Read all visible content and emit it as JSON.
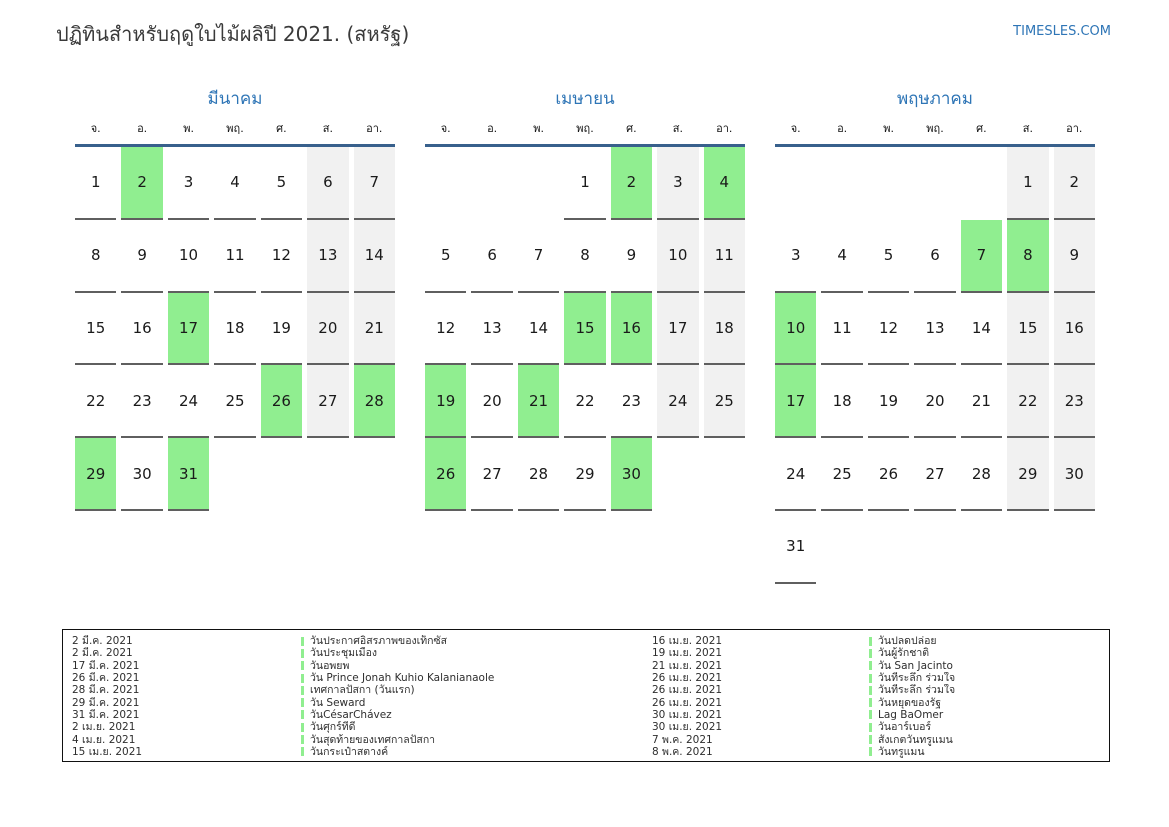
{
  "header": {
    "title": "ปฏิทินสำหรับฤดูใบไม้ผลิปี 2021. (สหรัฐ)",
    "site_link": "TIMESLES.COM"
  },
  "colors": {
    "accent_blue": "#2e75b6",
    "header_line_blue": "#38608c",
    "holiday_green": "#90ee90",
    "weekend_gray": "#f1f1f1"
  },
  "weekdays": [
    "จ.",
    "อ.",
    "พ.",
    "พฤ.",
    "ศ.",
    "ส.",
    "อา."
  ],
  "months": [
    {
      "name": "มีนาคม",
      "weeks": [
        [
          {
            "day": 1,
            "type": "normal"
          },
          {
            "day": 2,
            "type": "holiday"
          },
          {
            "day": 3,
            "type": "normal"
          },
          {
            "day": 4,
            "type": "normal"
          },
          {
            "day": 5,
            "type": "normal"
          },
          {
            "day": 6,
            "type": "weekend"
          },
          {
            "day": 7,
            "type": "weekend"
          }
        ],
        [
          {
            "day": 8,
            "type": "normal"
          },
          {
            "day": 9,
            "type": "normal"
          },
          {
            "day": 10,
            "type": "normal"
          },
          {
            "day": 11,
            "type": "normal"
          },
          {
            "day": 12,
            "type": "normal"
          },
          {
            "day": 13,
            "type": "weekend"
          },
          {
            "day": 14,
            "type": "weekend"
          }
        ],
        [
          {
            "day": 15,
            "type": "normal"
          },
          {
            "day": 16,
            "type": "normal"
          },
          {
            "day": 17,
            "type": "holiday"
          },
          {
            "day": 18,
            "type": "normal"
          },
          {
            "day": 19,
            "type": "normal"
          },
          {
            "day": 20,
            "type": "weekend"
          },
          {
            "day": 21,
            "type": "weekend"
          }
        ],
        [
          {
            "day": 22,
            "type": "normal"
          },
          {
            "day": 23,
            "type": "normal"
          },
          {
            "day": 24,
            "type": "normal"
          },
          {
            "day": 25,
            "type": "normal"
          },
          {
            "day": 26,
            "type": "holiday"
          },
          {
            "day": 27,
            "type": "weekend"
          },
          {
            "day": 28,
            "type": "holiday"
          }
        ],
        [
          {
            "day": 29,
            "type": "holiday"
          },
          {
            "day": 30,
            "type": "normal"
          },
          {
            "day": 31,
            "type": "holiday"
          },
          null,
          null,
          null,
          null
        ]
      ]
    },
    {
      "name": "เมษายน",
      "weeks": [
        [
          null,
          null,
          null,
          {
            "day": 1,
            "type": "normal"
          },
          {
            "day": 2,
            "type": "holiday"
          },
          {
            "day": 3,
            "type": "weekend"
          },
          {
            "day": 4,
            "type": "holiday"
          }
        ],
        [
          {
            "day": 5,
            "type": "normal"
          },
          {
            "day": 6,
            "type": "normal"
          },
          {
            "day": 7,
            "type": "normal"
          },
          {
            "day": 8,
            "type": "normal"
          },
          {
            "day": 9,
            "type": "normal"
          },
          {
            "day": 10,
            "type": "weekend"
          },
          {
            "day": 11,
            "type": "weekend"
          }
        ],
        [
          {
            "day": 12,
            "type": "normal"
          },
          {
            "day": 13,
            "type": "normal"
          },
          {
            "day": 14,
            "type": "normal"
          },
          {
            "day": 15,
            "type": "holiday"
          },
          {
            "day": 16,
            "type": "holiday"
          },
          {
            "day": 17,
            "type": "weekend"
          },
          {
            "day": 18,
            "type": "weekend"
          }
        ],
        [
          {
            "day": 19,
            "type": "holiday"
          },
          {
            "day": 20,
            "type": "normal"
          },
          {
            "day": 21,
            "type": "holiday"
          },
          {
            "day": 22,
            "type": "normal"
          },
          {
            "day": 23,
            "type": "normal"
          },
          {
            "day": 24,
            "type": "weekend"
          },
          {
            "day": 25,
            "type": "weekend"
          }
        ],
        [
          {
            "day": 26,
            "type": "holiday"
          },
          {
            "day": 27,
            "type": "normal"
          },
          {
            "day": 28,
            "type": "normal"
          },
          {
            "day": 29,
            "type": "normal"
          },
          {
            "day": 30,
            "type": "holiday"
          },
          null,
          null
        ]
      ]
    },
    {
      "name": "พฤษภาคม",
      "weeks": [
        [
          null,
          null,
          null,
          null,
          null,
          {
            "day": 1,
            "type": "weekend"
          },
          {
            "day": 2,
            "type": "weekend"
          }
        ],
        [
          {
            "day": 3,
            "type": "normal"
          },
          {
            "day": 4,
            "type": "normal"
          },
          {
            "day": 5,
            "type": "normal"
          },
          {
            "day": 6,
            "type": "normal"
          },
          {
            "day": 7,
            "type": "holiday"
          },
          {
            "day": 8,
            "type": "holiday"
          },
          {
            "day": 9,
            "type": "weekend"
          }
        ],
        [
          {
            "day": 10,
            "type": "holiday"
          },
          {
            "day": 11,
            "type": "normal"
          },
          {
            "day": 12,
            "type": "normal"
          },
          {
            "day": 13,
            "type": "normal"
          },
          {
            "day": 14,
            "type": "normal"
          },
          {
            "day": 15,
            "type": "weekend"
          },
          {
            "day": 16,
            "type": "weekend"
          }
        ],
        [
          {
            "day": 17,
            "type": "holiday"
          },
          {
            "day": 18,
            "type": "normal"
          },
          {
            "day": 19,
            "type": "normal"
          },
          {
            "day": 20,
            "type": "normal"
          },
          {
            "day": 21,
            "type": "normal"
          },
          {
            "day": 22,
            "type": "weekend"
          },
          {
            "day": 23,
            "type": "weekend"
          }
        ],
        [
          {
            "day": 24,
            "type": "normal"
          },
          {
            "day": 25,
            "type": "normal"
          },
          {
            "day": 26,
            "type": "normal"
          },
          {
            "day": 27,
            "type": "normal"
          },
          {
            "day": 28,
            "type": "normal"
          },
          {
            "day": 29,
            "type": "weekend"
          },
          {
            "day": 30,
            "type": "weekend"
          }
        ],
        [
          {
            "day": 31,
            "type": "normal"
          },
          null,
          null,
          null,
          null,
          null,
          null
        ]
      ]
    }
  ],
  "legend": {
    "rows": [
      {
        "date1": "2 มี.ค. 2021",
        "label1": "วันประกาศอิสรภาพของเท็กซัส",
        "date2": "16 เม.ย. 2021",
        "label2": "วันปลดปล่อย"
      },
      {
        "date1": "2 มี.ค. 2021",
        "label1": "วันประชุมเมือง",
        "date2": "19 เม.ย. 2021",
        "label2": "วันผู้รักชาติ"
      },
      {
        "date1": "17 มี.ค. 2021",
        "label1": "วันอพยพ",
        "date2": "21 เม.ย. 2021",
        "label2": "วัน San Jacinto"
      },
      {
        "date1": "26 มี.ค. 2021",
        "label1": "วัน Prince Jonah Kuhio Kalanianaole",
        "date2": "26 เม.ย. 2021",
        "label2": "วันที่ระลึก ร่วมใจ"
      },
      {
        "date1": "28 มี.ค. 2021",
        "label1": "เทศกาลปัสกา (วันแรก)",
        "date2": "26 เม.ย. 2021",
        "label2": "วันที่ระลึก ร่วมใจ"
      },
      {
        "date1": "29 มี.ค. 2021",
        "label1": "วัน Seward",
        "date2": "26 เม.ย. 2021",
        "label2": "วันหยุดของรัฐ"
      },
      {
        "date1": "31 มี.ค. 2021",
        "label1": "วันCésarChávez",
        "date2": "30 เม.ย. 2021",
        "label2": "Lag BaOmer"
      },
      {
        "date1": "2 เม.ย. 2021",
        "label1": "วันศุกร์ที่ดี",
        "date2": "30 เม.ย. 2021",
        "label2": "วันอาร์เบอร์"
      },
      {
        "date1": "4 เม.ย. 2021",
        "label1": "วันสุดท้ายของเทศกาลปัสกา",
        "date2": "7 พ.ค. 2021",
        "label2": "สังเกตวันทรูแมน"
      },
      {
        "date1": "15 เม.ย. 2021",
        "label1": "วันกระเป๋าสตางค์",
        "date2": "8 พ.ค. 2021",
        "label2": "วันทรูแมน"
      }
    ]
  }
}
